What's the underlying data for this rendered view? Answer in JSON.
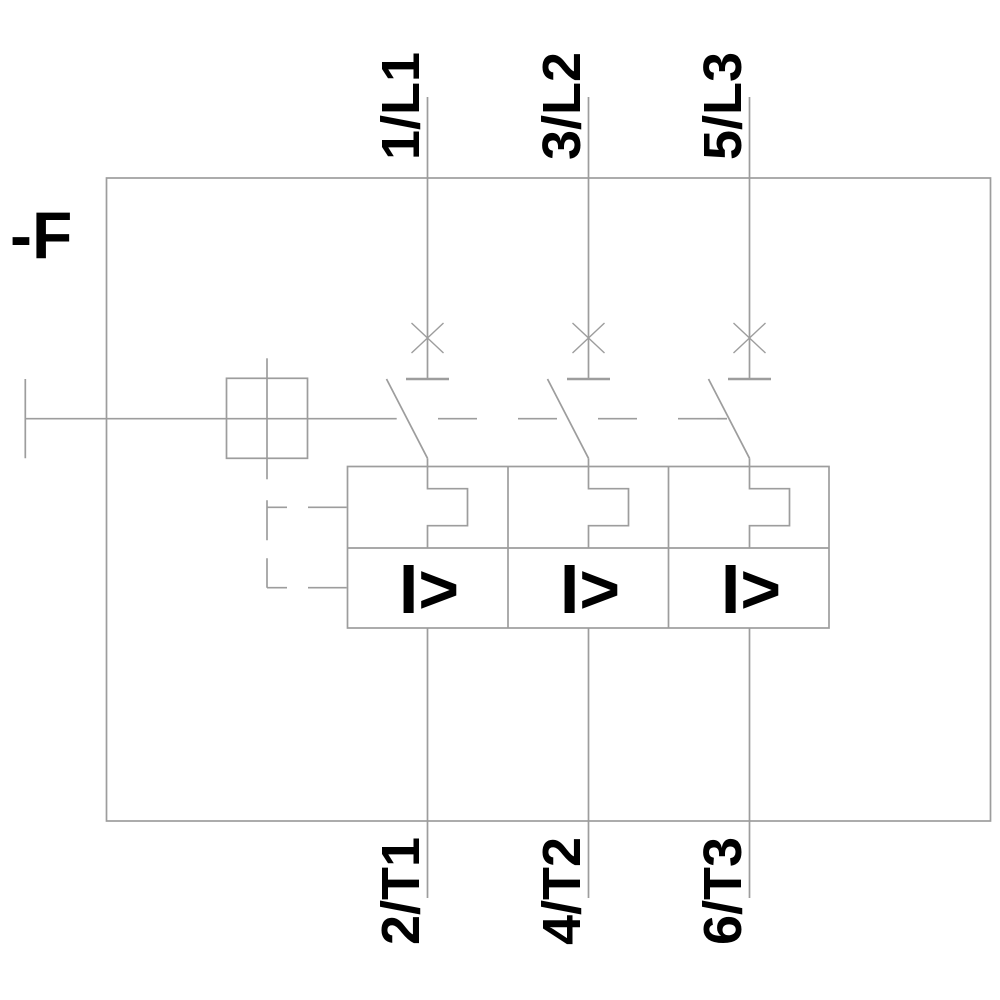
{
  "diagram": {
    "labels": {
      "device": "-F",
      "top": [
        "1/L1",
        "3/L2",
        "5/L3"
      ],
      "bottom": [
        "2/T1",
        "4/T2",
        "6/T3"
      ],
      "overcurrent": "I>"
    },
    "colors": {
      "line": "#9d9d9d",
      "text": "#000000",
      "background": "#ffffff"
    }
  }
}
